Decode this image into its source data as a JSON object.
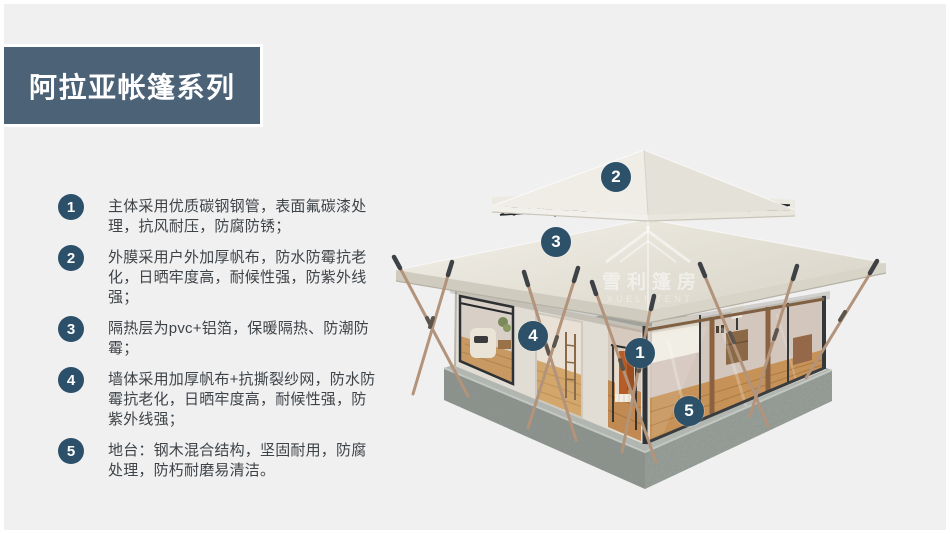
{
  "slide": {
    "background_color": "#f0f0f1",
    "accent_color": "#2d5169",
    "title_banner": {
      "label": "阿拉亚帐篷系列",
      "bg_color": "#4c6277",
      "text_color": "#ffffff"
    },
    "features": [
      {
        "num": "1",
        "text": "主体采用优质碳钢钢管，表面氟碳漆处理，抗风耐压，防腐防锈；"
      },
      {
        "num": "2",
        "text": "外膜采用户外加厚帆布，防水防霉抗老化，日晒牢度高，耐候性强，防紫外线强；"
      },
      {
        "num": "3",
        "text": "隔热层为pvc+铝箔，保暖隔热、防潮防霉；"
      },
      {
        "num": "4",
        "text": "墙体采用加厚帆布+抗撕裂纱网，防水防霉抗老化，日晒牢度高，耐候性强，防紫外线强；"
      },
      {
        "num": "5",
        "text": "地台：钢木混合结构，坚固耐用，防腐处理，防朽耐磨易清洁。"
      }
    ],
    "tent": {
      "callout_color": "#2d5169",
      "callouts": [
        {
          "label": "1"
        },
        {
          "label": "2"
        },
        {
          "label": "3"
        },
        {
          "label": "4"
        },
        {
          "label": "5"
        }
      ],
      "watermark": {
        "cn": "雪利篷房",
        "en": "XUELI TENT"
      }
    }
  }
}
